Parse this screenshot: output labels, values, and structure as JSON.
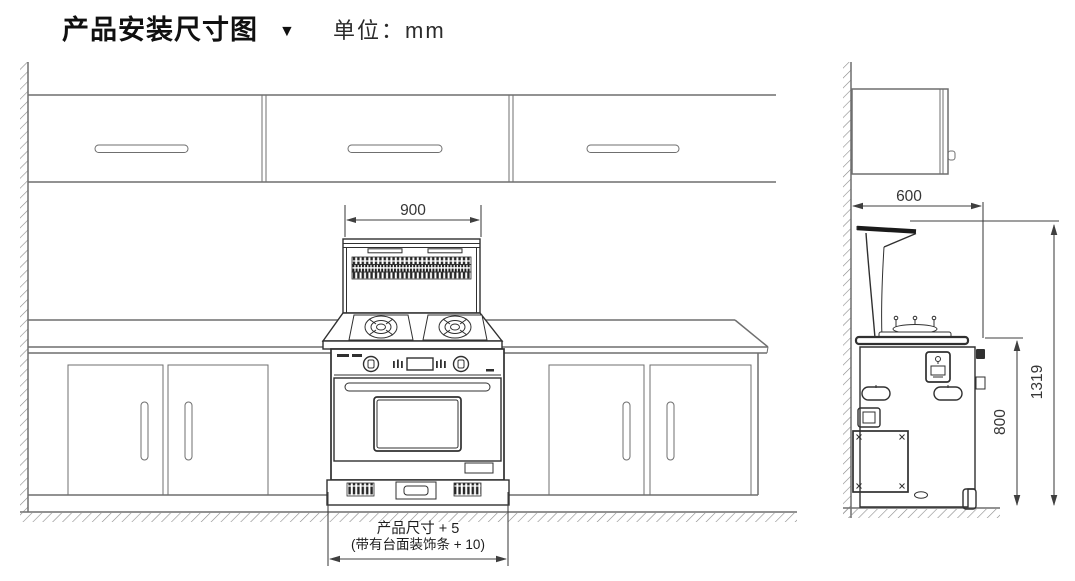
{
  "header": {
    "title": "产品安装尺寸图",
    "marker": "▼",
    "unit": "单位：mm"
  },
  "front_view": {
    "label": "front-elevation",
    "dim_hood_width": "900",
    "note_line1": "产品尺寸 + 5",
    "note_line2": "(带有台面装饰条 + 10)"
  },
  "side_view": {
    "label": "side-elevation",
    "dim_depth": "600",
    "dim_counter_height": "800",
    "dim_total_height": "1319"
  },
  "colors": {
    "outline": "#6f6f6f",
    "detail": "#303030",
    "dimension": "#3f3f3f",
    "hatch": "#8a8a8a",
    "vent_dark": "#262626",
    "fill_white": "#ffffff"
  }
}
